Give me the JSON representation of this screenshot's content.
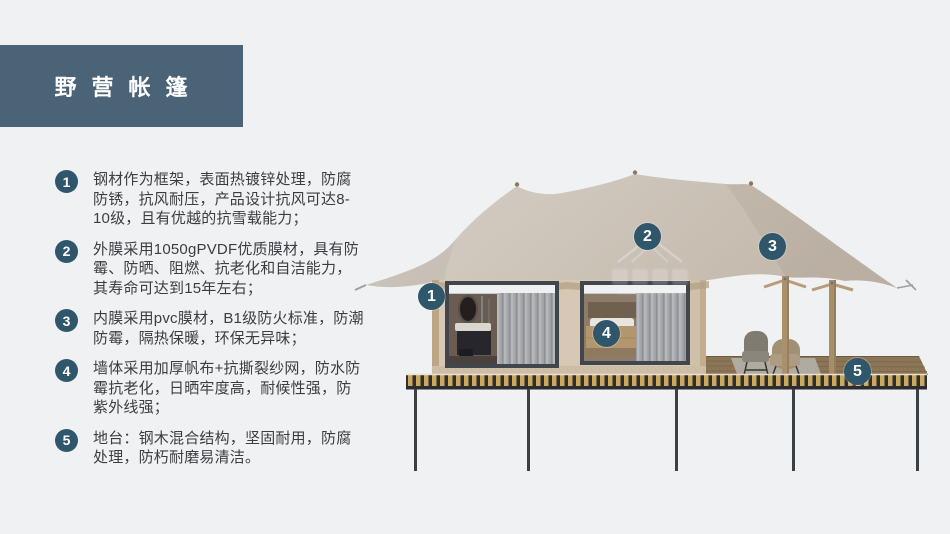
{
  "slide": {
    "title": "野营帐篷",
    "colors": {
      "background": "#f0f1f2",
      "title_block": "#4a6376",
      "accent_badge": "#2f566b",
      "body_text": "#3c3d42",
      "canopy": "#cdc3b7",
      "wall": "#d6c8b4",
      "deck_slat": "#caa85e"
    }
  },
  "features": [
    {
      "number": "1",
      "text": "钢材作为框架，表面热镀锌处理，防腐防锈，抗风耐压，产品设计抗风可达8-10级，且有优越的抗雪载能力；"
    },
    {
      "number": "2",
      "text": "外膜采用1050gPVDF优质膜材，具有防霉、防晒、阻燃、抗老化和自洁能力，其寿命可达到15年左右；"
    },
    {
      "number": "3",
      "text": "内膜采用pvc膜材，B1级防火标准，防潮防霉，隔热保暖，环保无异味；"
    },
    {
      "number": "4",
      "text": "墙体采用加厚帆布+抗撕裂纱网，防水防霉抗老化，日晒牢度高，耐候性强，防紫外线强；"
    },
    {
      "number": "5",
      "text": "地台：钢木混合结构，坚固耐用，防腐处理，防朽耐磨易清洁。"
    }
  ],
  "diagram": {
    "description": "glamping safari tent side view with numbered callouts",
    "markers": [
      {
        "number": "1"
      },
      {
        "number": "2"
      },
      {
        "number": "3"
      },
      {
        "number": "4"
      },
      {
        "number": "5"
      }
    ]
  }
}
